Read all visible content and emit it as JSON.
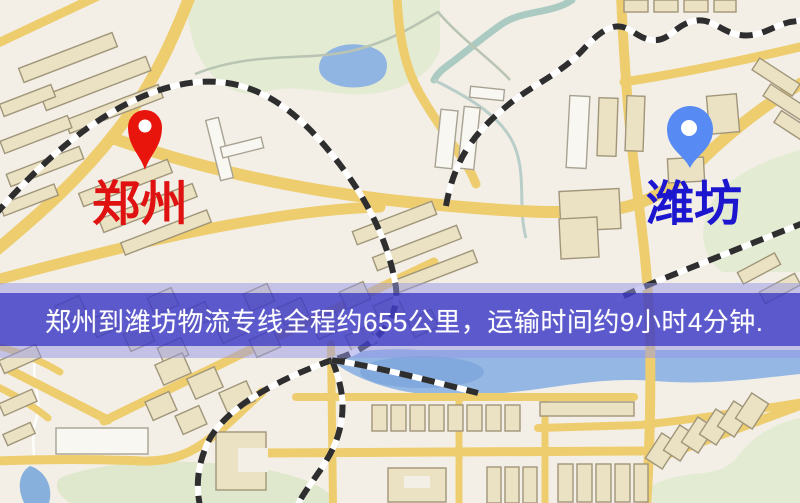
{
  "banner": {
    "text": "郑州到潍坊物流专线全程约655公里，运输时间约9小时4分钟."
  },
  "markers": {
    "origin": {
      "label": "郑州",
      "pin_color": "#e8150d",
      "label_color": "#e01111"
    },
    "destination": {
      "label": "潍坊",
      "pin_color": "#578af2",
      "label_color": "#1c16cf"
    }
  },
  "colors": {
    "banner_solid": "#3e3cc6",
    "banner_edge": "#9496e4",
    "road": "#f0cd6a",
    "water": "#8fb5e6",
    "park": "#e3ebd1"
  }
}
